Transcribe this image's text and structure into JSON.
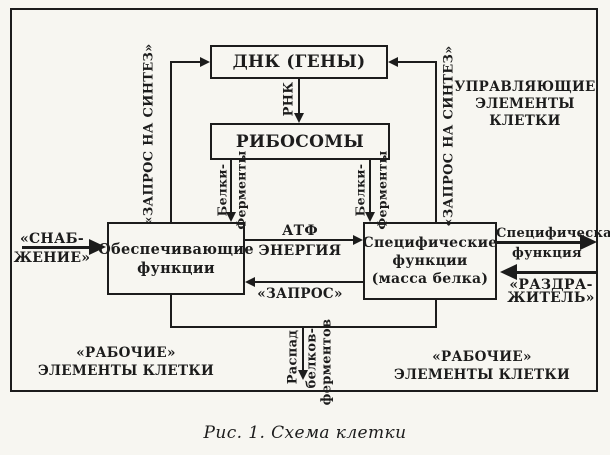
{
  "colors": {
    "ink": "#1c1c1c",
    "paper": "#f7f6f1"
  },
  "caption": "Рис. 1. Схема клетки",
  "boxes": {
    "dna": "ДНК (ГЕНЫ)",
    "ribosomes": "РИБОСОМЫ",
    "supporting": "Обеспечивающие функции",
    "specific": "Специфические функции (масса белка)"
  },
  "labels": {
    "request_synthesis": "«ЗАПРОС НА СИНТЕЗ»",
    "rna": "РНК",
    "proteins_word1": "Белки-",
    "proteins_word2": "Ферменты",
    "controlling_elements": "УПРАВЛЯЮЩИЕ ЭЛЕМЕНТЫ КЛЕТКИ",
    "atp": "АТФ",
    "energy": "ЭНЕРГИЯ",
    "request": "«ЗАПРОС»",
    "supply_line1": "«СНАБ-",
    "supply_line2": "ЖЕНИЕ»",
    "specific_function_line1": "Специфическая",
    "specific_function_line2": "функция",
    "stimulus_line1": "«РАЗДРА-",
    "stimulus_line2": "ЖИТЕЛЬ»",
    "working_elements": "«РАБОЧИЕ» ЭЛЕМЕНТЫ КЛЕТКИ",
    "decay_word1": "Распад",
    "decay_word2": "белков-",
    "decay_word3": "ферментов"
  }
}
